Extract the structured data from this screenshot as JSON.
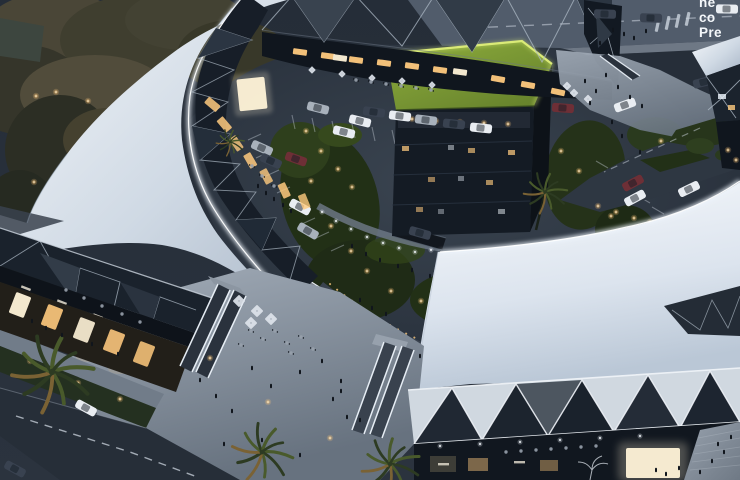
{
  "watermark": {
    "lines": [
      "ne",
      "co",
      "Pre"
    ],
    "color": "#f4f7fa",
    "note_visible_fragments_only": true
  },
  "palette": {
    "roof_hi": "#f4f7fa",
    "roof_mid": "#cfd9e4",
    "roof_lo": "#a8b5c6",
    "roof_se_hi": "#f7f9fc",
    "roof_se_mid": "#dce4ee",
    "roof_se_lo": "#bac7d6",
    "court_hi": "#3a4450",
    "court_lo": "#262e39",
    "plaza_hi": "#a3adb9",
    "plaza_lo": "#67727f",
    "stairs_hi": "#97a1ad",
    "stairs_lo": "#6f7985",
    "ground_hi": "#252d38",
    "ground_lo": "#2b333e",
    "asphalt": "#2c3540",
    "road": "#515c6b",
    "sidewalk": "#7b8593",
    "facade_dark": "#141b24",
    "facet_frame": "#aeb9c5",
    "facet_light": "#d0d8e0",
    "green_dark": "#223016",
    "green_mid": "#2e3f1c",
    "green_roof_hi": "#8fae3d",
    "green_roof_lo": "#66822c",
    "green_edge": "#dfef7a",
    "warm": "#ffca7e",
    "warm_core": "#fff3d8",
    "cool": "#eef5fc",
    "road_line": "#ccd4de",
    "car_white": "#e9edf2",
    "car_silver": "#a8b1bb",
    "car_dark": "#394250",
    "car_red": "#6e2f36",
    "people": "#10151c",
    "palm_dark": "#2d3b22",
    "palm_mid": "#495a2b",
    "palm_warm": "#7a6234",
    "umbrella": "#dde3ea",
    "table": "#98a1ac",
    "text": "#f4f7fa"
  }
}
